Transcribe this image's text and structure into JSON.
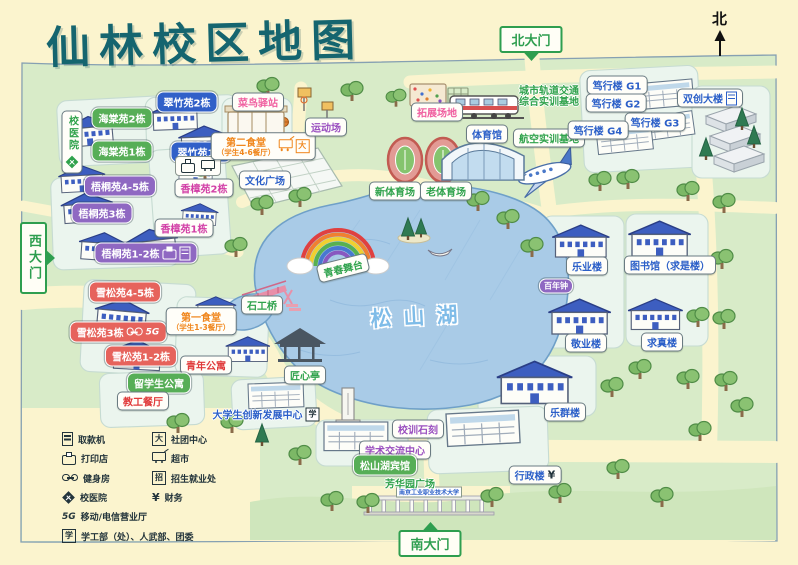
{
  "title": "仙林校区地图",
  "compass": {
    "label": "北"
  },
  "gates": [
    {
      "id": "north",
      "label": "北大门"
    },
    {
      "id": "west",
      "label": "西大门"
    },
    {
      "id": "south",
      "label": "南大门"
    }
  ],
  "lake": {
    "name": "松山湖"
  },
  "campus_gate_sign": "南京工业职业技术大学",
  "colors": {
    "background": "#FBF4CE",
    "map_green": "#D8EBC8",
    "lake": "#A9CBE7",
    "title_teal": "#15656F",
    "gate_green": "#2E9E4F",
    "chip_blue": "#3160C8",
    "chip_green": "#57AE57",
    "chip_purple": "#8F68C2",
    "chip_red": "#E6635C",
    "text_blue": "#2B5FC8",
    "text_green": "#2FA24B",
    "text_purple": "#9A4FC0",
    "text_pink": "#F05FA0",
    "text_orange": "#F0861C",
    "text_red": "#E03A3A",
    "text_magenta": "#D23FA6"
  },
  "labels": [
    {
      "name": "haitang-2",
      "text": "海棠苑2栋",
      "type": "chip green",
      "x": 122,
      "y": 118
    },
    {
      "name": "haitang-1",
      "text": "海棠苑1栋",
      "type": "chip green",
      "x": 122,
      "y": 151
    },
    {
      "name": "cuizhu-2",
      "text": "翠竹苑2栋",
      "type": "chip blue",
      "x": 187,
      "y": 102
    },
    {
      "name": "cuizhu-1",
      "text": "翠竹苑1栋",
      "type": "chip blue",
      "x": 201,
      "y": 152
    },
    {
      "name": "cuizhu-services",
      "text": "",
      "type": "mini",
      "x": 198,
      "y": 166,
      "icons": [
        "printer-icon",
        "cart-icon"
      ]
    },
    {
      "name": "cainiao-station",
      "text": "菜鸟驿站",
      "type": "box pink",
      "x": 258,
      "y": 102
    },
    {
      "name": "canteen-2",
      "text": "第二食堂",
      "sub": "（学生4-6餐厅）",
      "type": "box orange",
      "x": 263,
      "y": 146,
      "icons": [
        "cart-icon",
        "club-icon"
      ]
    },
    {
      "name": "culture-square",
      "text": "文化广场",
      "type": "box blue",
      "x": 265,
      "y": 180
    },
    {
      "name": "wutong-45",
      "text": "梧桐苑4-5栋",
      "type": "chip purple",
      "x": 120,
      "y": 186
    },
    {
      "name": "wutong-3",
      "text": "梧桐苑3栋",
      "type": "chip purple",
      "x": 102,
      "y": 213
    },
    {
      "name": "xiangzhang-2",
      "text": "香樟苑2栋",
      "type": "box magenta",
      "x": 204,
      "y": 188
    },
    {
      "name": "xiangzhang-1",
      "text": "香樟苑1栋",
      "type": "box magenta",
      "x": 184,
      "y": 228
    },
    {
      "name": "wutong-12",
      "text": "梧桐苑1-2栋",
      "type": "chip purple",
      "x": 146,
      "y": 253,
      "icons": [
        "printer-icon",
        "atm-icon"
      ]
    },
    {
      "name": "xuesong-45",
      "text": "雪松苑4-5栋",
      "type": "chip red",
      "x": 125,
      "y": 292
    },
    {
      "name": "xuesong-3",
      "text": "雪松苑3栋",
      "type": "chip red",
      "x": 118,
      "y": 332,
      "icons": [
        "gym-icon",
        "fiveg-icon"
      ]
    },
    {
      "name": "xuesong-12",
      "text": "雪松苑1-2栋",
      "type": "chip red",
      "x": 141,
      "y": 356
    },
    {
      "name": "canteen-1",
      "text": "第一食堂",
      "sub": "（学生1-3餐厅）",
      "type": "box orange",
      "x": 201,
      "y": 321
    },
    {
      "name": "youth-apartment",
      "text": "青年公寓",
      "type": "box red",
      "x": 206,
      "y": 365
    },
    {
      "name": "intl-student-dorm",
      "text": "留学生公寓",
      "type": "chip green",
      "x": 159,
      "y": 383
    },
    {
      "name": "staff-canteen",
      "text": "教工餐厅",
      "type": "box red",
      "x": 143,
      "y": 401
    },
    {
      "name": "hospital",
      "text": "校医院",
      "type": "box green vert",
      "x": 72,
      "y": 142,
      "icons": [
        "hospital-icon"
      ]
    },
    {
      "name": "sports-ground",
      "text": "运动场",
      "type": "box purple",
      "x": 326,
      "y": 127
    },
    {
      "name": "expansion-field",
      "text": "拓展场地",
      "type": "box pink",
      "x": 437,
      "y": 112
    },
    {
      "name": "rail-transit-base",
      "text": "城市轨道交通",
      "sub": "综合实训基地",
      "type": "text green",
      "x": 549,
      "y": 95
    },
    {
      "name": "gym-hall",
      "text": "体育馆",
      "type": "box blue",
      "x": 487,
      "y": 134
    },
    {
      "name": "aviation-base",
      "text": "航空实训基地",
      "type": "box green",
      "x": 549,
      "y": 138
    },
    {
      "name": "new-stadium",
      "text": "新体育场",
      "type": "box green",
      "x": 395,
      "y": 191
    },
    {
      "name": "old-stadium",
      "text": "老体育场",
      "type": "box green",
      "x": 446,
      "y": 191
    },
    {
      "name": "duxing-g1",
      "text": "笃行楼 G1",
      "type": "box blue",
      "x": 617,
      "y": 85
    },
    {
      "name": "duxing-g2",
      "text": "笃行楼 G2",
      "type": "box blue",
      "x": 616,
      "y": 103
    },
    {
      "name": "duxing-g3",
      "text": "笃行楼 G3",
      "type": "box blue",
      "x": 655,
      "y": 122
    },
    {
      "name": "duxing-g4",
      "text": "笃行楼 G4",
      "type": "box blue",
      "x": 598,
      "y": 130
    },
    {
      "name": "shuangchuang-building",
      "text": "双创大楼",
      "type": "box blue",
      "x": 710,
      "y": 98,
      "icons": [
        "atm-icon"
      ]
    },
    {
      "name": "leye-building",
      "text": "乐业楼",
      "type": "box blue",
      "x": 587,
      "y": 266
    },
    {
      "name": "library",
      "text": "图书馆（求是楼）",
      "type": "box blue",
      "x": 670,
      "y": 265
    },
    {
      "name": "bainianzhong",
      "text": "百年钟",
      "type": "chip purple sm",
      "x": 556,
      "y": 286
    },
    {
      "name": "jingye-building",
      "text": "敬业楼",
      "type": "box blue",
      "x": 586,
      "y": 343
    },
    {
      "name": "qiuzhen-building",
      "text": "求真楼",
      "type": "box blue",
      "x": 662,
      "y": 342
    },
    {
      "name": "lequn-building",
      "text": "乐群楼",
      "type": "box blue",
      "x": 565,
      "y": 412
    },
    {
      "name": "admin-building",
      "text": "行政楼",
      "type": "box blue",
      "x": 535,
      "y": 475,
      "icons": [
        "finance-icon"
      ]
    },
    {
      "name": "shigong-bridge",
      "text": "石工桥",
      "type": "box green",
      "x": 262,
      "y": 305
    },
    {
      "name": "jiangxin-pavilion",
      "text": "匠心亭",
      "type": "box green",
      "x": 305,
      "y": 375
    },
    {
      "name": "youth-stage",
      "text": "青春舞台",
      "type": "box green",
      "x": 343,
      "y": 268,
      "rotate": -14
    },
    {
      "name": "motto-stone",
      "text": "校训石刻",
      "type": "box purple",
      "x": 418,
      "y": 429
    },
    {
      "name": "academic-exchange-center",
      "text": "学术交流中心",
      "type": "box purple",
      "x": 395,
      "y": 450
    },
    {
      "name": "songshanhu-hotel",
      "text": "松山湖宾馆",
      "type": "chip green",
      "x": 385,
      "y": 465
    },
    {
      "name": "fanghua-square",
      "text": "芳华园广场",
      "type": "text green",
      "x": 410,
      "y": 483
    },
    {
      "name": "innovation-center",
      "text": "大学生创新发展中心",
      "type": "text blue",
      "x": 266,
      "y": 414,
      "icons": [
        "xue-icon"
      ]
    }
  ],
  "legend": {
    "columns": [
      [
        {
          "icon": "atm-icon",
          "label": "取款机"
        },
        {
          "icon": "printer-icon",
          "label": "打印店"
        },
        {
          "icon": "gym-icon",
          "label": "健身房"
        },
        {
          "icon": "hospital-icon",
          "label": "校医院"
        }
      ],
      [
        {
          "icon": "club-icon",
          "label": "社团中心"
        },
        {
          "icon": "cart-icon",
          "label": "超市"
        },
        {
          "icon": "recruit-icon",
          "label": "招生就业处"
        },
        {
          "icon": "finance-icon",
          "label": "财务"
        }
      ]
    ],
    "rows": [
      {
        "icon": "fiveg-icon",
        "label": "移动/电信营业厅"
      },
      {
        "icon": "xue-icon",
        "label": "学工部（处）、人武部、团委"
      }
    ],
    "icon_glyphs": {
      "club": "大",
      "recruit": "招",
      "finance": "¥",
      "fiveg": "5G",
      "xue": "学"
    }
  }
}
